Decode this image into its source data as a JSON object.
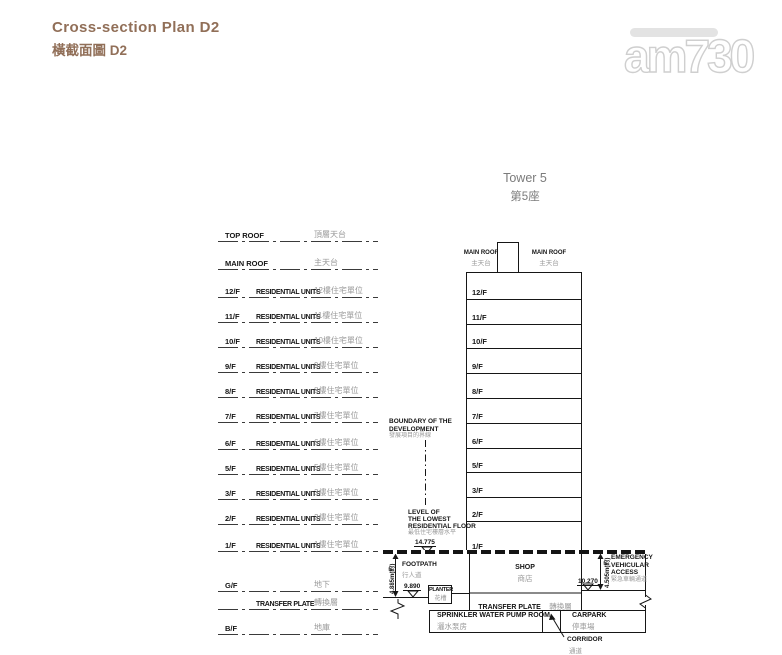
{
  "page": {
    "title_en": "Cross-section Plan D2",
    "title_zh": "橫截面圖 D2"
  },
  "watermark": {
    "brand": "am730"
  },
  "tower_caption": {
    "en": "Tower 5",
    "zh": "第5座"
  },
  "legend": {
    "rows": [
      {
        "code": "TOP ROOF",
        "units": "",
        "zh": "頂層天台"
      },
      {
        "code": "MAIN ROOF",
        "units": "",
        "zh": "主天台"
      },
      {
        "code": "12/F",
        "units": "RESIDENTIAL UNITS",
        "zh": "12樓住宅單位"
      },
      {
        "code": "11/F",
        "units": "RESIDENTIAL UNITS",
        "zh": "11樓住宅單位"
      },
      {
        "code": "10/F",
        "units": "RESIDENTIAL UNITS",
        "zh": "10樓住宅單位"
      },
      {
        "code": "9/F",
        "units": "RESIDENTIAL UNITS",
        "zh": "9樓住宅單位"
      },
      {
        "code": "8/F",
        "units": "RESIDENTIAL UNITS",
        "zh": "8樓住宅單位"
      },
      {
        "code": "7/F",
        "units": "RESIDENTIAL UNITS",
        "zh": "7樓住宅單位"
      },
      {
        "code": "6/F",
        "units": "RESIDENTIAL UNITS",
        "zh": "6樓住宅單位"
      },
      {
        "code": "5/F",
        "units": "RESIDENTIAL UNITS",
        "zh": "5樓住宅單位"
      },
      {
        "code": "3/F",
        "units": "RESIDENTIAL UNITS",
        "zh": "3樓住宅單位"
      },
      {
        "code": "2/F",
        "units": "RESIDENTIAL UNITS",
        "zh": "2樓住宅單位"
      },
      {
        "code": "1/F",
        "units": "RESIDENTIAL UNITS",
        "zh": "1樓住宅單位"
      },
      {
        "code": "G/F",
        "units": "",
        "zh": "地下"
      },
      {
        "code": "",
        "units": "TRANSFER PLATE",
        "zh": "轉換層"
      },
      {
        "code": "B/F",
        "units": "",
        "zh": "地庫"
      }
    ]
  },
  "tower": {
    "floors": [
      "12/F",
      "11/F",
      "10/F",
      "9/F",
      "8/F",
      "7/F",
      "6/F",
      "5/F",
      "3/F",
      "2/F",
      "1/F"
    ],
    "main_roof_left": {
      "en": "MAIN ROOF",
      "zh": "主天台"
    },
    "main_roof_right": {
      "en": "MAIN ROOF",
      "zh": "主天台"
    }
  },
  "annotations": {
    "boundary": {
      "en1": "BOUNDARY OF THE",
      "en2": "DEVELOPMENT",
      "zh": "發展項目的界線"
    },
    "lowest_level": {
      "en1": "LEVEL OF",
      "en2": "THE LOWEST",
      "en3": "RESIDENTIAL FLOOR",
      "zh": "最低住宅樓層水平",
      "value": "14.775"
    },
    "footpath": {
      "en": "FOOTPATH",
      "zh": "行人道",
      "level": "9.890"
    },
    "left_dimension": "4.885m(約)",
    "planter": {
      "en": "PLANTER",
      "zh": "花槽"
    },
    "shop": {
      "en": "SHOP",
      "zh": "商店"
    },
    "transfer_plate": {
      "en": "TRANSFER PLATE",
      "zh": "轉換層"
    },
    "sprinkler_room": {
      "en": "SPRINKLER WATER PUMP ROOM",
      "zh": "灑水泵房"
    },
    "carpark": {
      "en": "CARPARK",
      "zh": "停車場"
    },
    "corridor": {
      "en": "CORRIDOR",
      "zh": "通道"
    },
    "eva": {
      "en1": "EMERGENCY",
      "en2": "VEHICULAR",
      "en3": "ACCESS",
      "zh": "緊急車輛通道",
      "level": "10.270",
      "dimension": "4.505m(約)"
    }
  },
  "colors": {
    "title": "#916f58",
    "drawing": "#141414",
    "secondary_text": "#9a9a9a",
    "caption": "#7b7b7b"
  }
}
